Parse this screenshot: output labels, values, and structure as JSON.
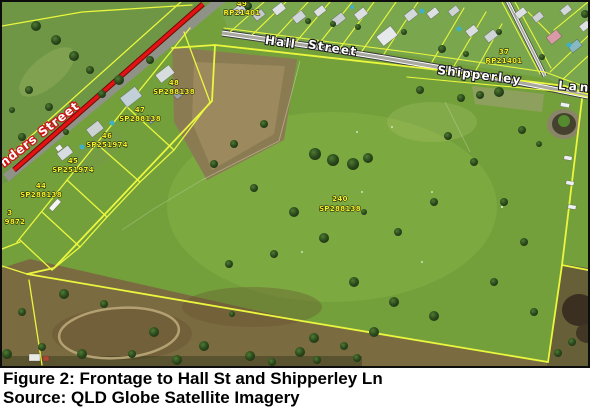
{
  "figure": {
    "caption": "Figure 2: Frontage to Hall St and Shipperley Ln",
    "source": "Source: QLD Globe Satellite Imagery"
  },
  "map": {
    "streets": {
      "flinders_partial": "nders Street",
      "hall_word1": "Hall",
      "hall_word2": "Street",
      "shipperley": "Shipperley",
      "lane": "Lane"
    },
    "parcels": [
      {
        "lot": "49",
        "plan": "RP21401"
      },
      {
        "lot": "37",
        "plan": "RP21401"
      },
      {
        "lot": "48",
        "plan": "SP288138"
      },
      {
        "lot": "47",
        "plan": "SP288138"
      },
      {
        "lot": "46",
        "plan": "SP251974"
      },
      {
        "lot": "45",
        "plan": "SP251974"
      },
      {
        "lot": "44",
        "plan": "SP288138"
      },
      {
        "lot": "3",
        "plan": "9872"
      },
      {
        "lot": "240",
        "plan": "SP288138"
      }
    ],
    "colors": {
      "cadastral_line": "#eaf73e",
      "parcel_label_text": "#f7f32a",
      "closed_road_overlay": "#e21313",
      "street_label_text": "#ffffff",
      "grass": "#74a03c"
    }
  }
}
